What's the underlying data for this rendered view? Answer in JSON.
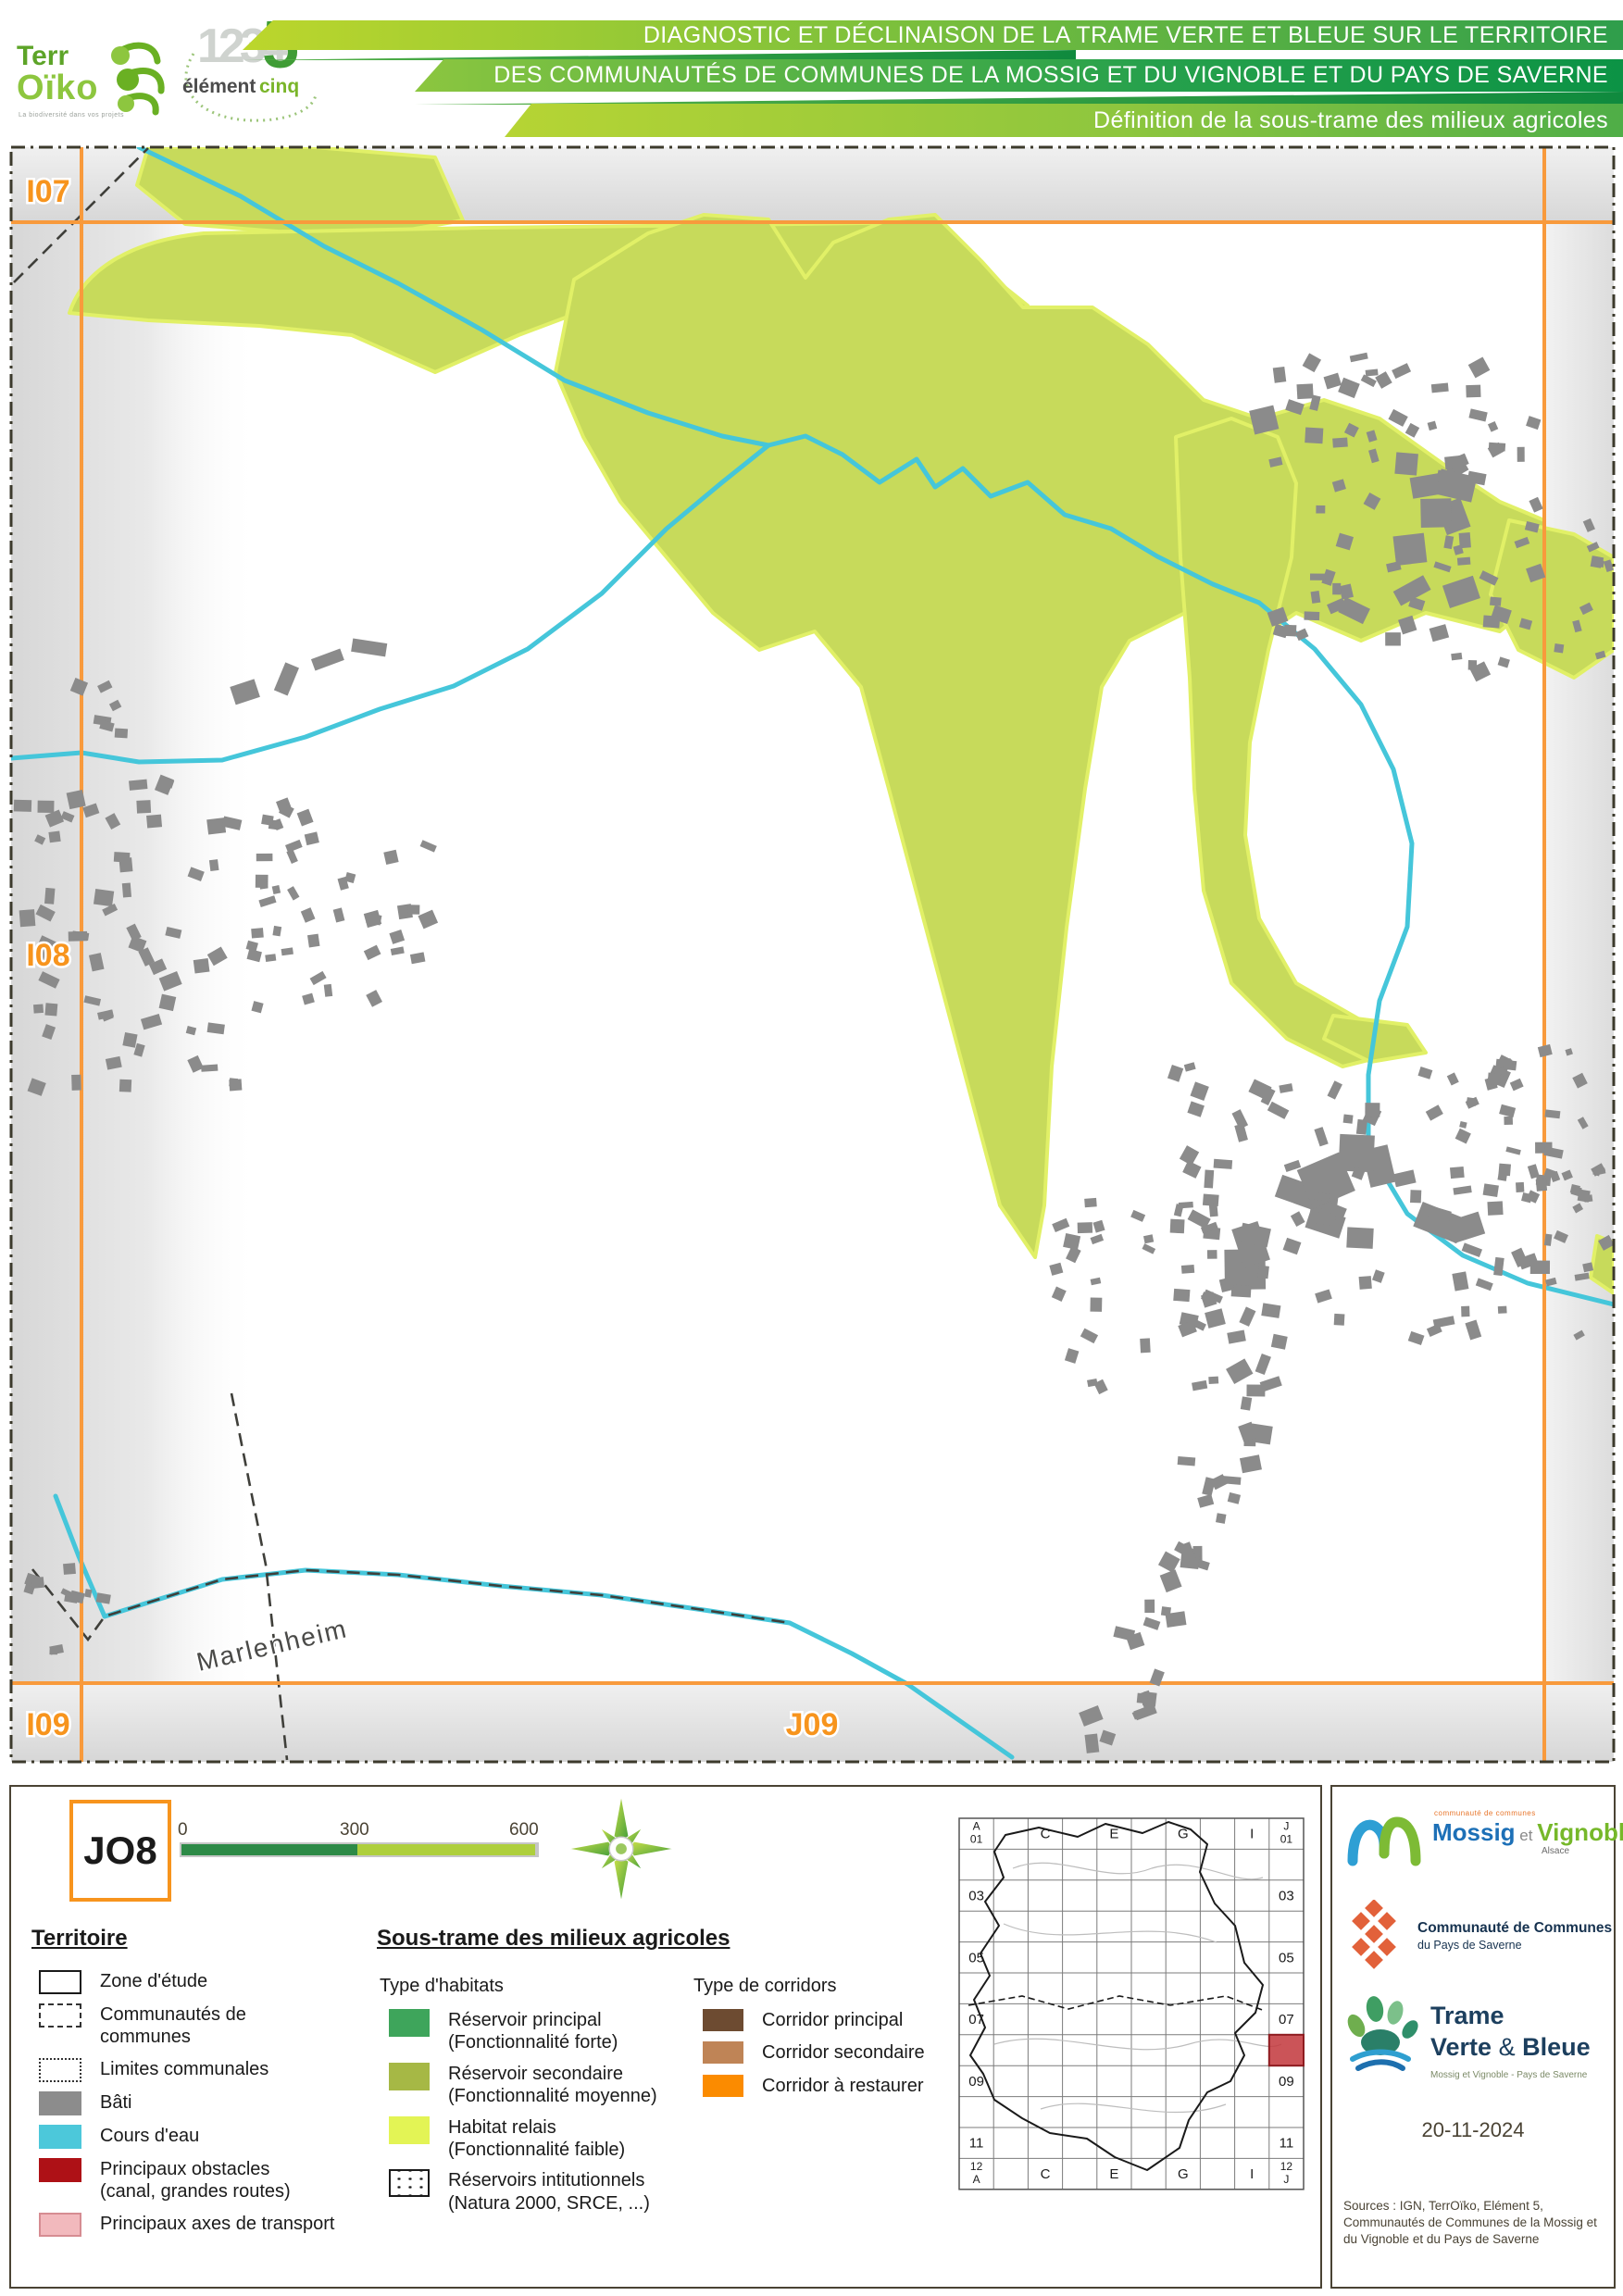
{
  "header": {
    "title_line1": "DIAGNOSTIC ET DÉCLINAISON DE LA TRAME VERTE ET BLEUE SUR LE TERRITOIRE",
    "title_line2": "DES COMMUNAUTÉS DE COMMUNES DE LA MOSSIG ET DU VIGNOBLE ET DU PAYS DE SAVERNE",
    "subtitle": "Définition de la sous-trame des milieux agricoles",
    "terroiko": {
      "name_top": "Terr",
      "name_bottom": "Oïko",
      "tagline": "La biodiversité dans vos projets"
    },
    "elementcinq": {
      "digits": "1234",
      "five": "5",
      "word1": "élément",
      "word2": "cinq"
    }
  },
  "map": {
    "sheet_labels": {
      "i07": "I07",
      "i08": "I08",
      "i09": "I09",
      "j09": "J09"
    },
    "town_label": "Marlenheim",
    "colors": {
      "reservoir_secondaire": "#c7da5b",
      "habitat_relais_fringe": "#e1f067",
      "river": "#45c6da",
      "building": "#8b8b8b",
      "sheet_grid": "#f89a3c",
      "outside_zone": "#d9d9d9"
    }
  },
  "legend": {
    "sheet_id": "JO8",
    "scale": {
      "t0": "0",
      "t300": "300",
      "t600": "600 m"
    },
    "territoire": {
      "heading": "Territoire",
      "items": [
        {
          "label": "Zone d'étude",
          "swatch": "outline-solid"
        },
        {
          "label": "Communautés de\ncommunes",
          "swatch": "outline-dashed"
        },
        {
          "label": "Limites communales",
          "swatch": "outline-dotted"
        },
        {
          "label": "Bâti",
          "swatch": "fill",
          "color": "#8c8c8c"
        },
        {
          "label": "Cours d'eau",
          "swatch": "fill",
          "color": "#4cc8da"
        },
        {
          "label": "Principaux obstacles\n(canal, grandes routes)",
          "swatch": "fill",
          "color": "#ae1116"
        },
        {
          "label": "Principaux axes de transport",
          "swatch": "fill-border",
          "color": "#f2b9bd",
          "border": "#d68c92"
        }
      ]
    },
    "sous_trame": {
      "heading": "Sous-trame des milieux agricoles",
      "habitats": {
        "heading": "Type d'habitats",
        "items": [
          {
            "label": "Réservoir principal\n(Fonctionnalité forte)",
            "swatch": "fill",
            "color": "#3ea55b"
          },
          {
            "label": "Réservoir secondaire\n(Fonctionnalité moyenne)",
            "swatch": "fill",
            "color": "#a6b845"
          },
          {
            "label": "Habitat relais\n(Fonctionnalité faible)",
            "swatch": "fill",
            "color": "#e3f455"
          },
          {
            "label": "Réservoirs intitutionnels\n(Natura 2000, SRCE, ...)",
            "swatch": "dots"
          }
        ]
      },
      "corridors": {
        "heading": "Type de corridors",
        "items": [
          {
            "label": "Corridor principal",
            "swatch": "fill",
            "color": "#6d4b31"
          },
          {
            "label": "Corridor secondaire",
            "swatch": "fill",
            "color": "#bf8456"
          },
          {
            "label": "Corridor à restaurer",
            "swatch": "fill",
            "color": "#fb8b00"
          }
        ]
      }
    }
  },
  "index_map": {
    "cols": 10,
    "rows": 12,
    "corner_labels": {
      "tl": [
        "A",
        "01"
      ],
      "tr": [
        "J",
        "01"
      ],
      "bl": [
        "12",
        "A"
      ],
      "br": [
        "12",
        "J"
      ]
    },
    "top_labels": [
      {
        "col": 3,
        "text": "C"
      },
      {
        "col": 5,
        "text": "E"
      },
      {
        "col": 7,
        "text": "G"
      },
      {
        "col": 9,
        "text": "I"
      }
    ],
    "bottom_labels": [
      {
        "col": 3,
        "text": "C"
      },
      {
        "col": 5,
        "text": "E"
      },
      {
        "col": 7,
        "text": "G"
      },
      {
        "col": 9,
        "text": "I"
      }
    ],
    "left_labels": [
      {
        "row": 3,
        "text": "03"
      },
      {
        "row": 5,
        "text": "05"
      },
      {
        "row": 7,
        "text": "07"
      },
      {
        "row": 9,
        "text": "09"
      },
      {
        "row": 11,
        "text": "11"
      }
    ],
    "right_labels": [
      {
        "row": 3,
        "text": "03"
      },
      {
        "row": 5,
        "text": "05"
      },
      {
        "row": 7,
        "text": "07"
      },
      {
        "row": 9,
        "text": "09"
      },
      {
        "row": 11,
        "text": "11"
      }
    ],
    "highlight": {
      "col": 10,
      "row": 8,
      "color": "#c2363b"
    }
  },
  "credits": {
    "date": "20-11-2024",
    "sources": "Sources : IGN, TerrOïko, Elément 5, Communautés de Communes de la Mossig et du Vignoble et du Pays de Saverne",
    "mossig": {
      "small": "communauté de communes",
      "word1": "Mossig",
      "et": " et ",
      "word2": "Vignoble",
      "region": "Alsace"
    },
    "saverne": {
      "line1": "Communauté de Communes",
      "line2": "du Pays de Saverne"
    },
    "tvb": {
      "line1": "Trame",
      "line2a": "Verte ",
      "amp": "& ",
      "line2b": "Bleue",
      "subtitle": "Mossig et Vignoble - Pays de Saverne"
    }
  }
}
